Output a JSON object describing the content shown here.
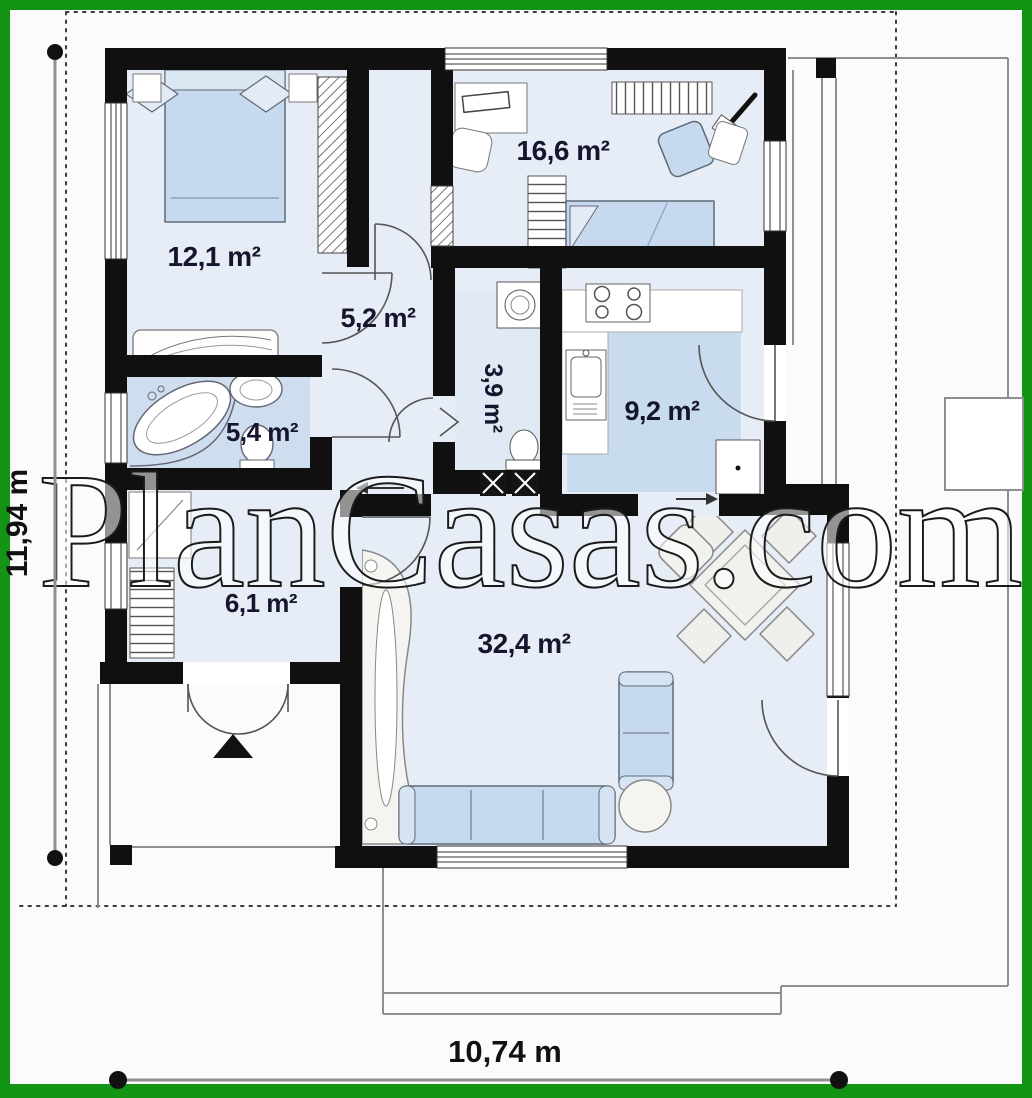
{
  "plan": {
    "watermark": "PlanCasas.com",
    "dimensions": {
      "height": "11,94 m",
      "width": "10,74 m"
    },
    "rooms": [
      {
        "id": "bedroom-1",
        "area": "12,1 m²"
      },
      {
        "id": "bedroom-2",
        "area": "16,6 m²"
      },
      {
        "id": "hallway",
        "area": "5,2 m²"
      },
      {
        "id": "utility-wc",
        "area": "3,9 m²"
      },
      {
        "id": "kitchen",
        "area": "9,2 m²"
      },
      {
        "id": "bathroom",
        "area": "5,4 m²"
      },
      {
        "id": "entry-hall",
        "area": "6,1 m²"
      },
      {
        "id": "living-room",
        "area": "32,4 m²"
      }
    ],
    "colors": {
      "border": "#149414",
      "wall": "#101010",
      "floor": "#e7edf6",
      "floor_accent": "#cfdeee",
      "kitchen_floor": "#c9dbee",
      "furniture": "#c6d9ee",
      "label": "#15152d",
      "dimension": "#111111"
    }
  }
}
